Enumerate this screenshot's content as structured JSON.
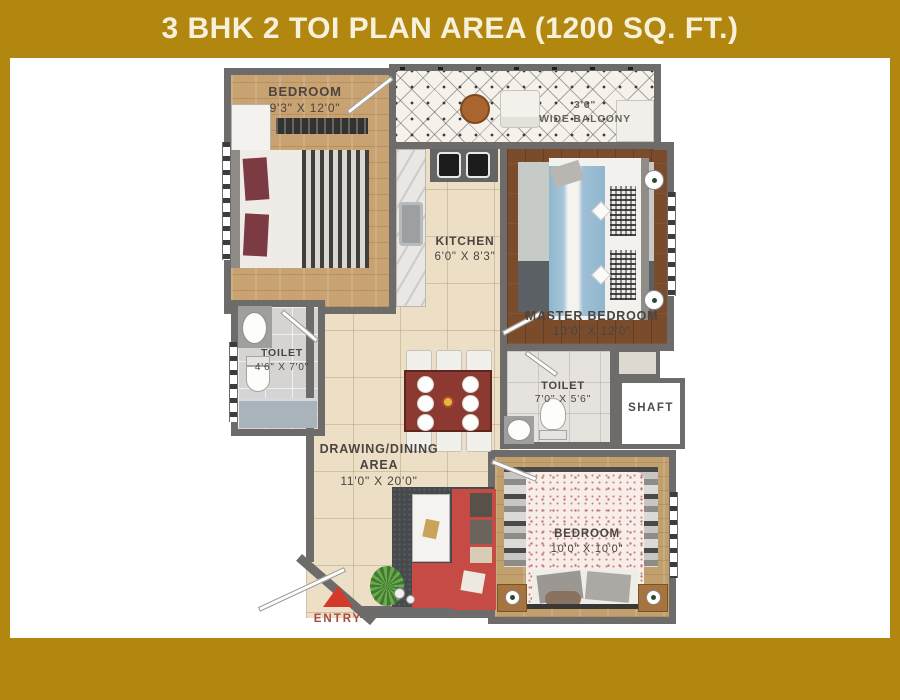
{
  "title": "3 BHK 2 TOI PLAN AREA (1200 SQ. FT.)",
  "colors": {
    "frame_gold": "#B2870F",
    "title_text": "#F7F1DC",
    "wall_grey": "#6E6B6B",
    "label_text": "#4B4440",
    "entry_text": "#A84741",
    "entry_arrow": "#D43A2C",
    "sofa_red": "#C74B45",
    "dining_table_red": "#8C3931"
  },
  "rooms": {
    "bedroom_top": {
      "name": "BEDROOM",
      "size": "9'3\" X 12'0\""
    },
    "balcony": {
      "width": "3'6\"",
      "name": "WIDE BALCONY"
    },
    "kitchen": {
      "name": "KITCHEN",
      "size": "6'0\" X 8'3\""
    },
    "master_bedroom": {
      "name": "MASTER BEDROOM",
      "size": "10'0\" X 12'0\""
    },
    "toilet_left": {
      "name": "TOILET",
      "size": "4'6\" X 7'0\""
    },
    "toilet_middle": {
      "name": "TOILET",
      "size": "7'0\" X 5'6\""
    },
    "shaft": {
      "name": "SHAFT"
    },
    "drawing_dining": {
      "name": "DRAWING/DINING",
      "name2": "AREA",
      "size": "11'0\" X 20'0\""
    },
    "bedroom_bottom": {
      "name": "BEDROOM",
      "size": "10'0\" X 10'0\""
    },
    "entry": {
      "name": "ENTRY"
    }
  }
}
